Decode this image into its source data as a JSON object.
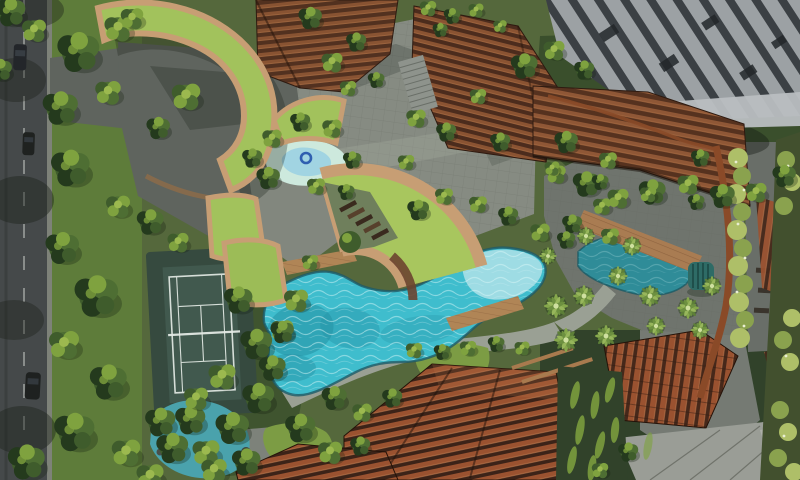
{
  "scene": {
    "type": "aerial-architectural-rendering",
    "setting": "condominium landscape deck, top-down bird's-eye view",
    "description": "Photoreal aerial render of a residential development: entry drop-off with curved green-roof canopy, tennis court, free-form lagoon pool with timber decks, fan-shaped green-roof pavilion with sun loungers, kids splash pool, leisure pond with boardwalk, paved plazas, rust jogging trail, terracotta-louvred towers, a grey high-rise and ribbed terracotta roofs amid dense tropical planting. A public road with cars runs along the left edge.",
    "features": [
      "road with lane markings and cars",
      "street tree verge",
      "entry drop-off driveway",
      "curved green-roof entrance canopy",
      "fan-shaped green roofs",
      "tennis court",
      "main lagoon swimming pool",
      "shallow pool shelf",
      "kids splash pool with float ring",
      "leisure pond",
      "lower garden pond",
      "timber pool decks",
      "timber boardwalk",
      "pool-side sun loungers",
      "winding garden paths",
      "paved plazas",
      "rust-coloured jogging trail",
      "terracotta louvred towers",
      "grey high-rise tower",
      "ribbed terracotta roofs",
      "concrete low-rise block",
      "hedges and flowering shrubs",
      "palm trees",
      "teal garden cabana"
    ]
  },
  "palette": {
    "road": "#45494a",
    "road_marking": "#cdd2cc",
    "kerb": "#7e8279",
    "car": "#23262a",
    "verge": "#5e7c3a",
    "garden_mid": "#55683c",
    "garden_dark": "#3a4f2c",
    "driveway": "#5f645e",
    "shadow": "#1d241c",
    "paving": "#868b82",
    "paving_dark": "#6f746d",
    "paver_line": "#5c6158",
    "path": "#9aa094",
    "tennis_surround": "#364a3f",
    "tennis_court": "#41594e",
    "tennis_line": "#d6ded8",
    "pool": "#3fbdcd",
    "pool_shallow": "#a9dfe7",
    "pool_deep": "#2591a4",
    "pool_rim": "#1e5a66",
    "caustic": "#dcf7f8",
    "pond": "#2f8c98",
    "pond_light": "#4aa2ac",
    "splash_outer": "#cde9dd",
    "splash_inner": "#9ed3e2",
    "float_ring": "#2f5fb0",
    "green_roof": "#a2c25c",
    "roof_trim": "#c79e74",
    "timber": "#b08556",
    "timber_line": "#7a5132",
    "terracotta": "#9a5230",
    "terracotta_dark": "#3c2318",
    "louver_face": "#52301f",
    "louver_ridge": "#8a5332",
    "tower_light": "#9ca1a4",
    "tower_dark": "#3b4044",
    "tower_beam": "#b9bec1",
    "concrete": "#9a9d96",
    "concrete_line": "#55584f",
    "trail": "#8a4a28",
    "hedge_light": "#aebf68",
    "hedge_mid": "#8aa24e",
    "flower": "#e9eed2",
    "foliage_dark": "#243a1d",
    "foliage_mid": "#3f5c2c",
    "foliage_mid2": "#4e6e33",
    "foliage_light": "#7fa23f",
    "foliage_hi": "#9cb94f",
    "palm": "#86a84c",
    "palm_dark": "#5d7f38",
    "lawn": "#7c9c44",
    "chair_dark": "#3a2a1e",
    "wall_brown": "#6b4430",
    "cabana": "#2e6b66"
  }
}
